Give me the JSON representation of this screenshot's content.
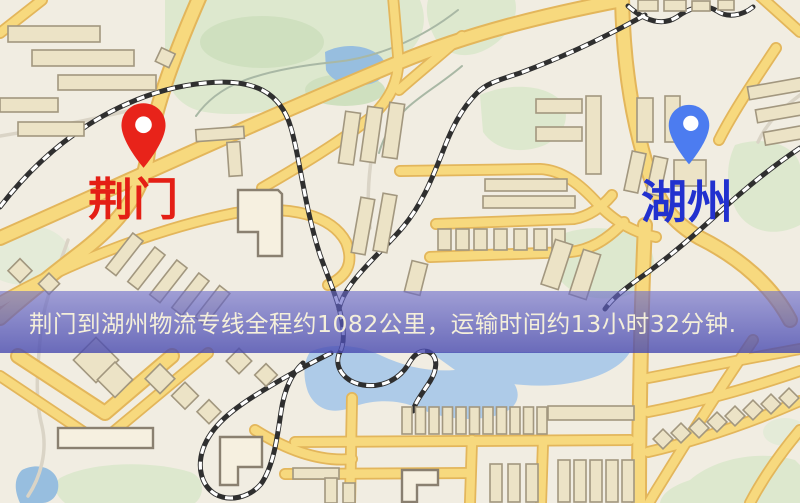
{
  "map": {
    "origin_marker": {
      "label": "荆门",
      "icon": "map-pin-icon",
      "pin_color": "#e8231a",
      "label_color": "#e41f15"
    },
    "destination_marker": {
      "label": "湖州",
      "icon": "map-pin-icon",
      "pin_color": "#4c7cf0",
      "label_color": "#2231cf"
    }
  },
  "banner": {
    "text": "荆门到湖州物流专线全程约1082公里，运输时间约13小时32分钟.",
    "background_color": "#5356b6",
    "text_color": "#f4efda"
  },
  "route": {
    "origin": "荆门",
    "destination": "湖州",
    "distance_km": "1082",
    "duration_hours": "13",
    "duration_minutes": "32"
  },
  "palette": {
    "map_background": "#f1ede2",
    "road_yellow": "#f7d97e",
    "road_casing": "#e3b65b",
    "park_green": "#dde8ce",
    "water_blue": "#97bedf",
    "railway_dark": "#2f2f2f",
    "building_fill": "#ece3c6",
    "building_stroke": "#a2977f"
  }
}
